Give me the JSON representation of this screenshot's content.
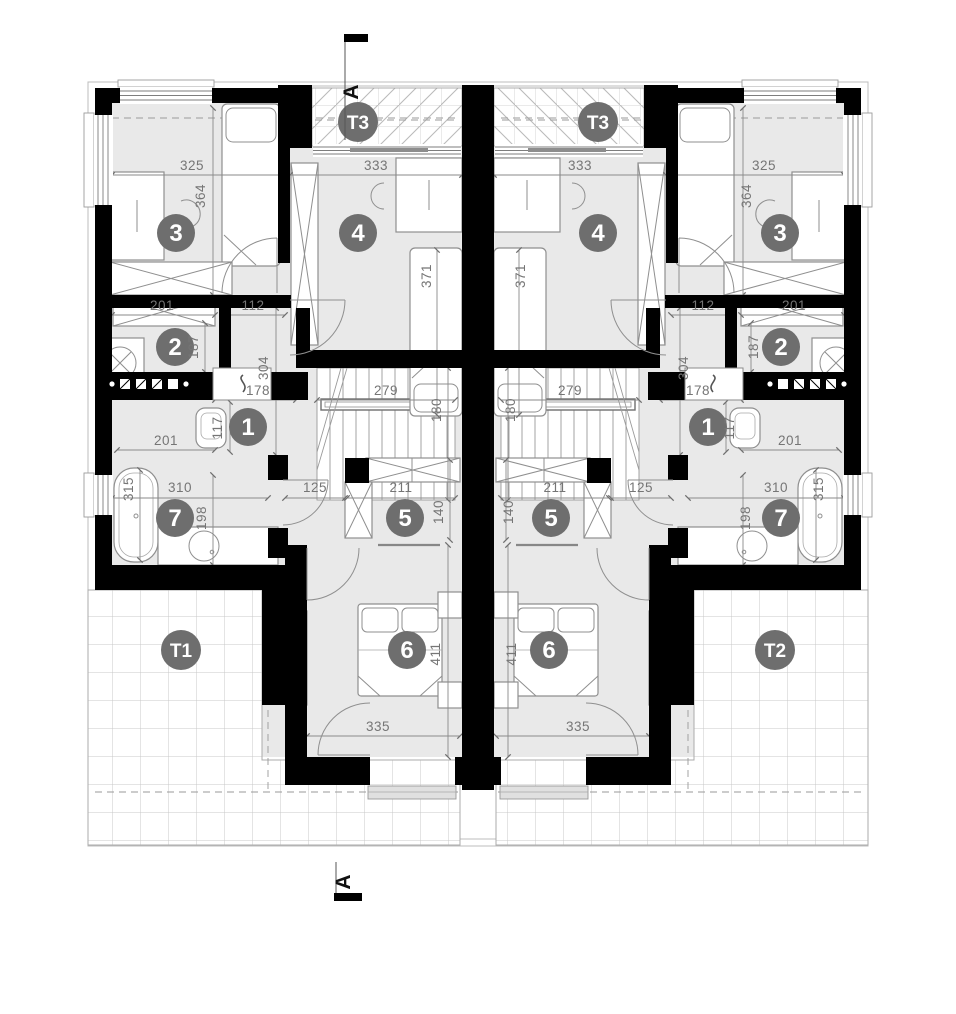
{
  "plan": {
    "title": "Semi-detached house upper floor plan",
    "section_marker": "A",
    "areas": {
      "balcony": "T3",
      "terrace_left": "T1",
      "terrace_right": "T2"
    },
    "rooms": {
      "r1": "1",
      "r2": "2",
      "r3": "3",
      "r4": "4",
      "r5": "5",
      "r6": "6",
      "r7": "7"
    },
    "dims": {
      "room3_width": "325",
      "room3_depth": "364",
      "room4_width": "333",
      "room4_bed": "371",
      "wardrobe_width": "201",
      "niche_width": "112",
      "wardrobe_depth": "187",
      "hall_depth": "304",
      "hall_width": "178",
      "stair_run": "279",
      "stair_width": "180",
      "wc_depth": "117",
      "wc_width": "201",
      "bath_width": "310",
      "bath_tub": "315",
      "bath_depth": "198",
      "landing_width": "125",
      "closet_width": "211",
      "closet_depth": "140",
      "bedroom_depth": "411",
      "bedroom_width": "335"
    },
    "colors": {
      "wall": "#000000",
      "room_fill": "#e9e9e9",
      "label_gray": "#6e6e6e",
      "dim_gray": "#757575"
    }
  }
}
